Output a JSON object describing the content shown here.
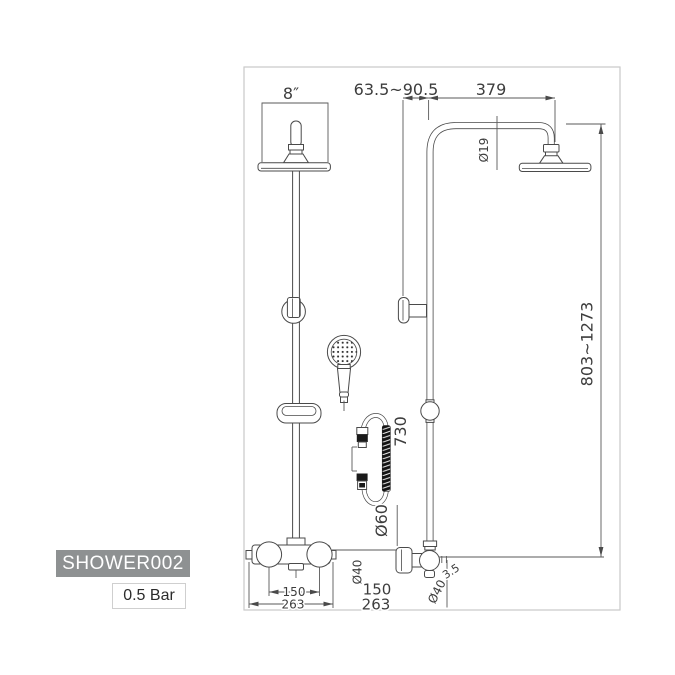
{
  "badges": {
    "model": "SHOWER002",
    "pressure": "0.5 Bar"
  },
  "dims": {
    "head_width": "8″",
    "wall_range": "63.5~90.5",
    "arm_length": "379",
    "riser_diameter": "Ø19",
    "height_range": "803~1273",
    "hose_length": "730",
    "flange_diameter": "Ø60",
    "handle_centers": "150",
    "valve_width": "263",
    "outlet_diameter": "Ø40",
    "offset_150": "150",
    "offset_263": "263",
    "inlet_diameter": "Ø40",
    "flange_depth": "3.5"
  },
  "colors": {
    "line": "#4a4a4a",
    "dim_text": "#3d3d3d",
    "frame": "#c9c9c9",
    "badge_bg": "#8e9192",
    "badge_text": "#ffffff",
    "hose_coil": "#1a1a1a"
  }
}
